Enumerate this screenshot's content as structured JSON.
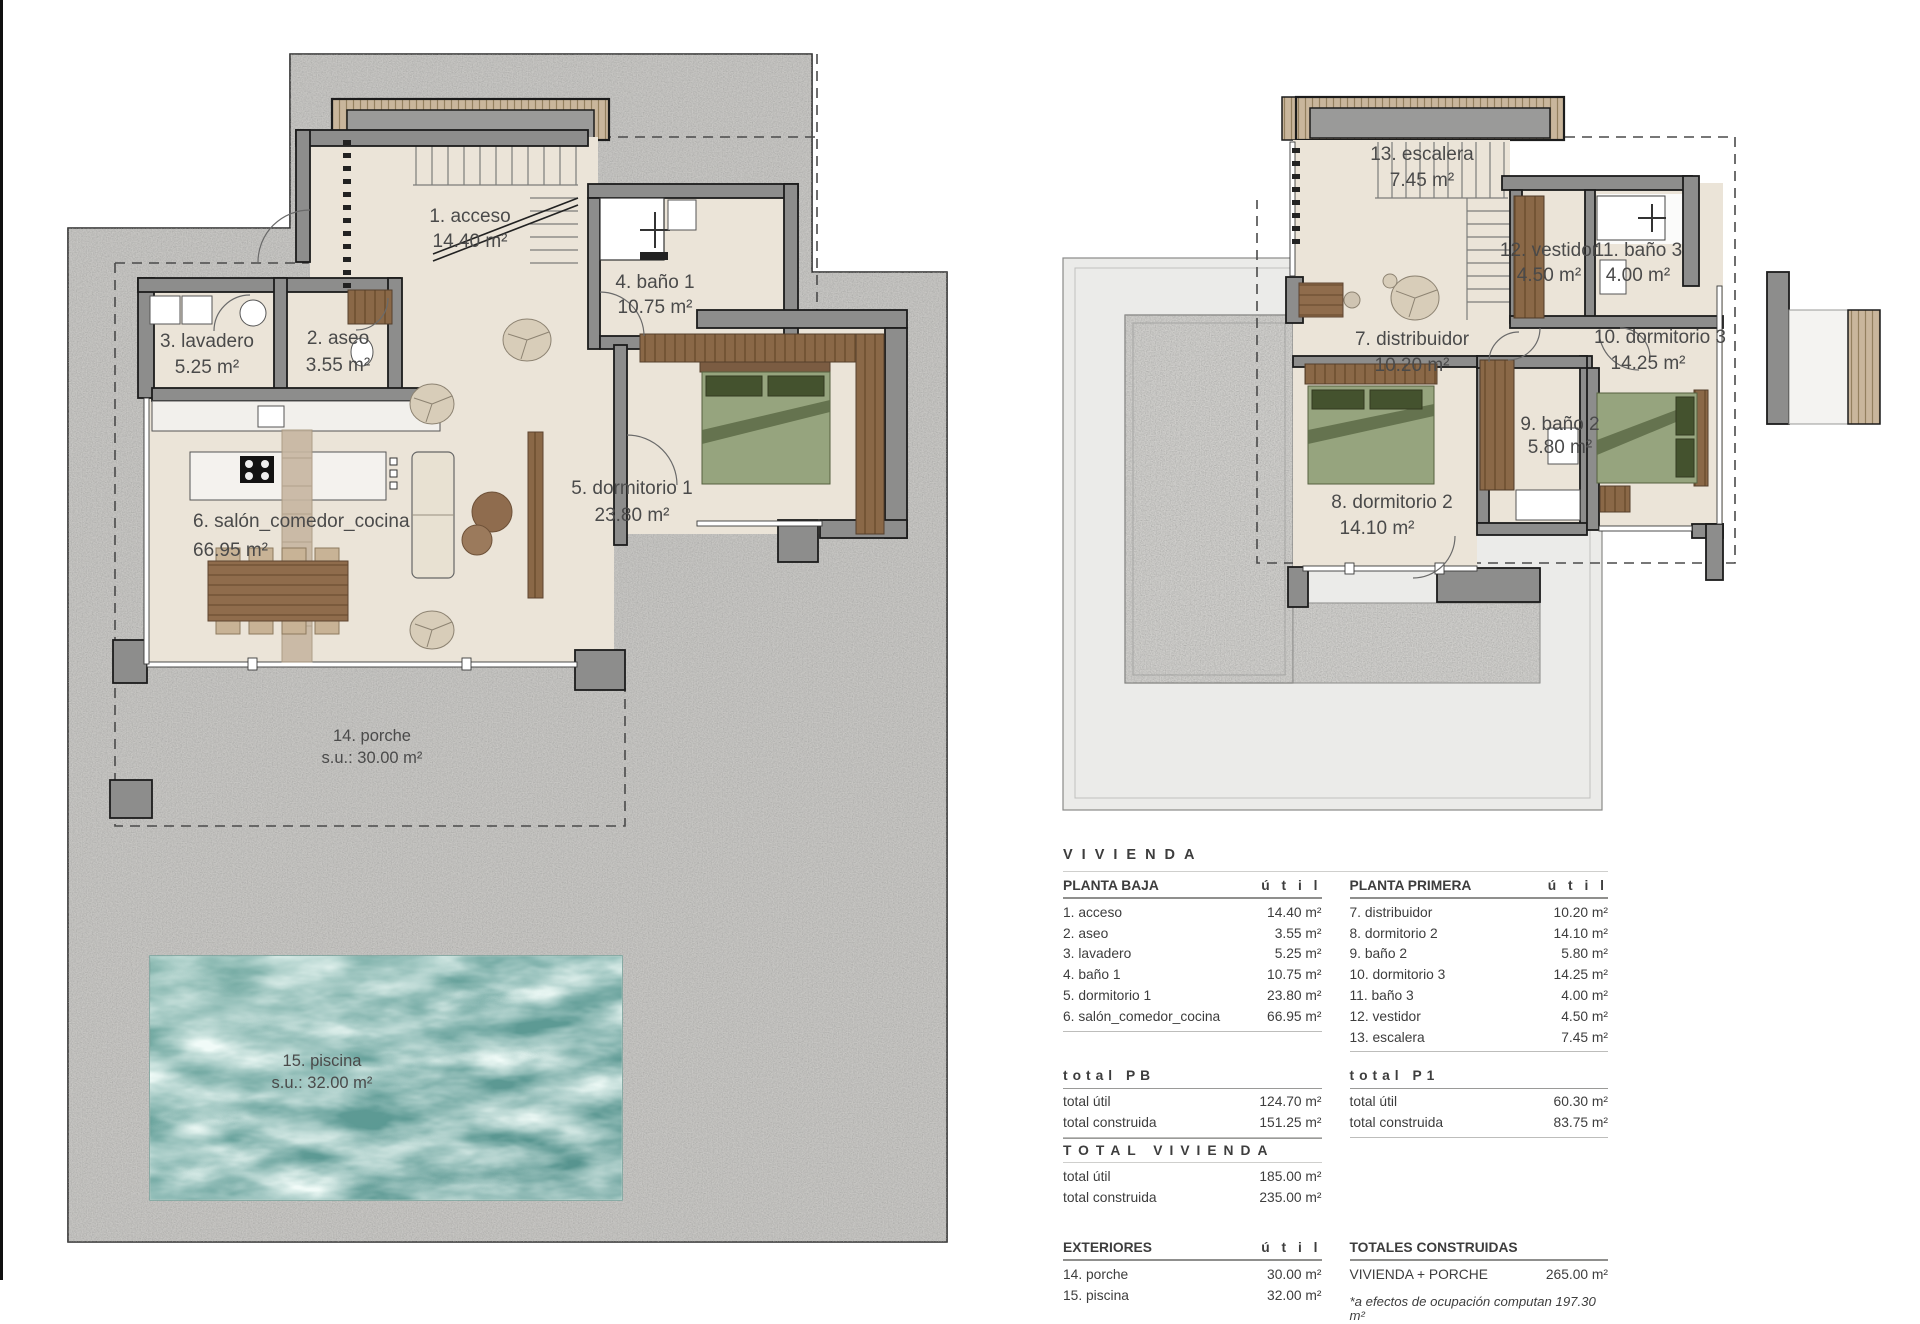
{
  "colors": {
    "gravel": "#c7c6c3",
    "interior": "#ebe4d8",
    "wall_gray": "#8d8d8c",
    "wall_line": "#1c1c1c",
    "wood": "#8a6847",
    "bed_green": "#96a47e",
    "pool_teal": "#64a09a",
    "panel_gray": "#ebebe9",
    "text": "#3d3d3d"
  },
  "plans": {
    "pb": {
      "rooms": [
        {
          "label": "1. acceso",
          "area": "14.40 m²"
        },
        {
          "label": "2. aseo",
          "area": "3.55 m²"
        },
        {
          "label": "3. lavadero",
          "area": "5.25 m²"
        },
        {
          "label": "4. baño 1",
          "area": "10.75 m²"
        },
        {
          "label": "5. dormitorio 1",
          "area": "23.80 m²"
        },
        {
          "label": "6. salón_comedor_cocina",
          "area": "66.95 m²"
        },
        {
          "label": "14. porche",
          "area": "s.u.: 30.00 m²"
        },
        {
          "label": "15. piscina",
          "area": "s.u.: 32.00 m²"
        }
      ]
    },
    "p1": {
      "rooms": [
        {
          "label": "13. escalera",
          "area": "7.45 m²"
        },
        {
          "label": "12. vestidor",
          "area": "4.50 m²"
        },
        {
          "label": "11. baño 3",
          "area": "4.00 m²"
        },
        {
          "label": "7. distribuidor",
          "area": "10.20 m²"
        },
        {
          "label": "10. dormitorio 3",
          "area": "14.25 m²"
        },
        {
          "label": "9. baño 2",
          "area": "5.80 m²"
        },
        {
          "label": "8. dormitorio 2",
          "area": "14.10 m²"
        }
      ]
    }
  },
  "table": {
    "title": "VIVIENDA",
    "col_util": "ú t i l",
    "pb": {
      "header": "PLANTA BAJA",
      "rows": [
        {
          "name": "1. acceso",
          "value": "14.40 m²"
        },
        {
          "name": "2. aseo",
          "value": "3.55 m²"
        },
        {
          "name": "3. lavadero",
          "value": "5.25 m²"
        },
        {
          "name": "4. baño 1",
          "value": "10.75 m²"
        },
        {
          "name": "5. dormitorio 1",
          "value": "23.80 m²"
        },
        {
          "name": "6. salón_comedor_cocina",
          "value": "66.95 m²"
        }
      ]
    },
    "p1": {
      "header": "PLANTA PRIMERA",
      "rows": [
        {
          "name": "7. distribuidor",
          "value": "10.20 m²"
        },
        {
          "name": "8. dormitorio 2",
          "value": "14.10 m²"
        },
        {
          "name": "9. baño 2",
          "value": "5.80 m²"
        },
        {
          "name": "10. dormitorio 3",
          "value": "14.25 m²"
        },
        {
          "name": "11. baño 3",
          "value": "4.00 m²"
        },
        {
          "name": "12. vestidor",
          "value": "4.50 m²"
        },
        {
          "name": "13. escalera",
          "value": "7.45 m²"
        }
      ]
    },
    "total_pb": {
      "header": "total PB",
      "rows": [
        {
          "name": "total útil",
          "value": "124.70 m²"
        },
        {
          "name": "total construida",
          "value": "151.25 m²"
        }
      ]
    },
    "total_p1": {
      "header": "total P1",
      "rows": [
        {
          "name": "total útil",
          "value": "60.30 m²"
        },
        {
          "name": "total construida",
          "value": "83.75 m²"
        }
      ]
    },
    "total_vivienda": {
      "header": "TOTAL VIVIENDA",
      "rows": [
        {
          "name": "total útil",
          "value": "185.00 m²"
        },
        {
          "name": "total construida",
          "value": "235.00 m²"
        }
      ]
    },
    "exteriores": {
      "header": "EXTERIORES",
      "rows": [
        {
          "name": "14. porche",
          "value": "30.00 m²"
        },
        {
          "name": "15. piscina",
          "value": "32.00 m²"
        }
      ]
    },
    "totales_construidas": {
      "header": "TOTALES CONSTRUIDAS",
      "rows": [
        {
          "name": "VIVIENDA + PORCHE",
          "value": "265.00 m²"
        }
      ]
    },
    "note": "*a efectos de ocupación computan 197.30 m²"
  }
}
